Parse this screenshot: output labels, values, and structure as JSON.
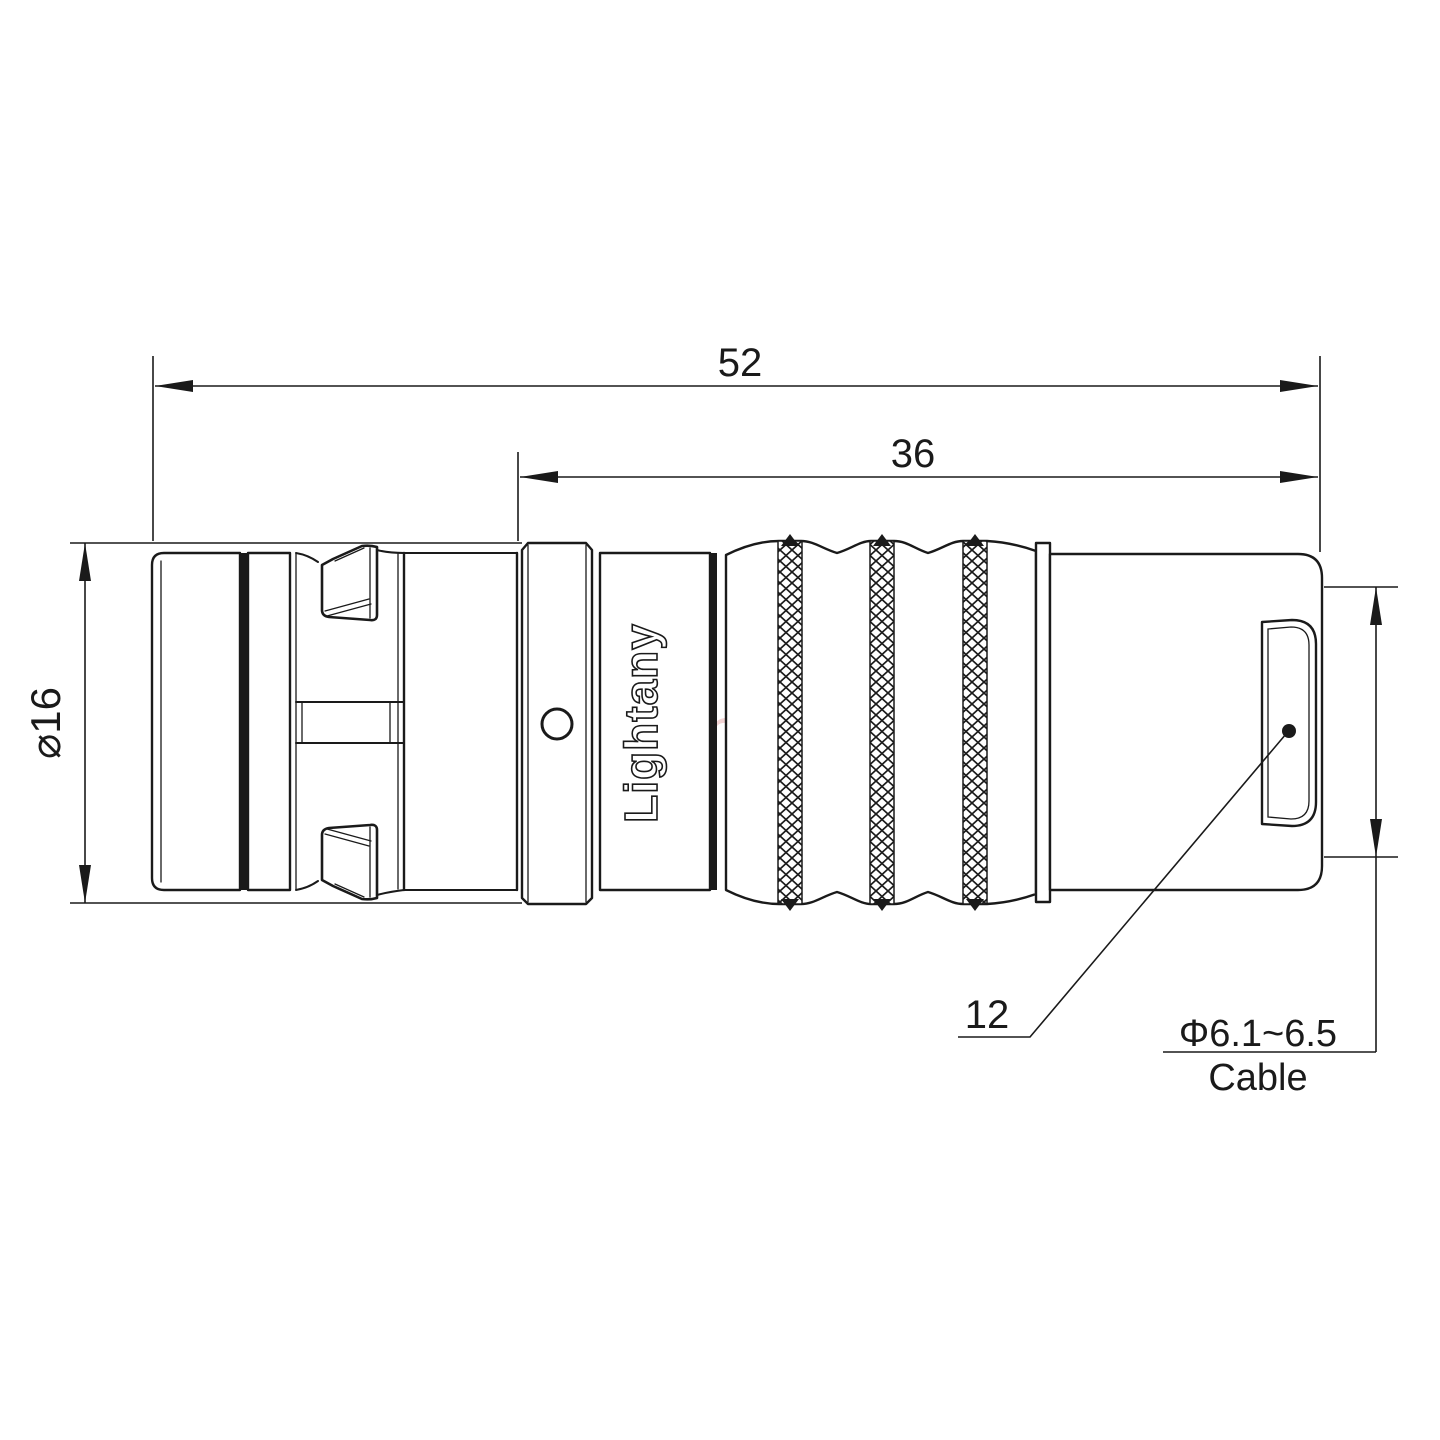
{
  "page": {
    "title": "Connector technical drawing"
  },
  "drawing": {
    "dimensions": {
      "overall_length": "52",
      "body_length": "36",
      "shell_diameter": "⌀16",
      "boss_diameter": "12",
      "cable_range": "Φ6.1~6.5",
      "cable_word": "Cable"
    },
    "branding": {
      "body_marking": "Lightany",
      "watermark": "Lightany"
    },
    "colors": {
      "line": "#1a1a1a",
      "watermark": "#e8b0b0",
      "background": "#ffffff"
    }
  }
}
